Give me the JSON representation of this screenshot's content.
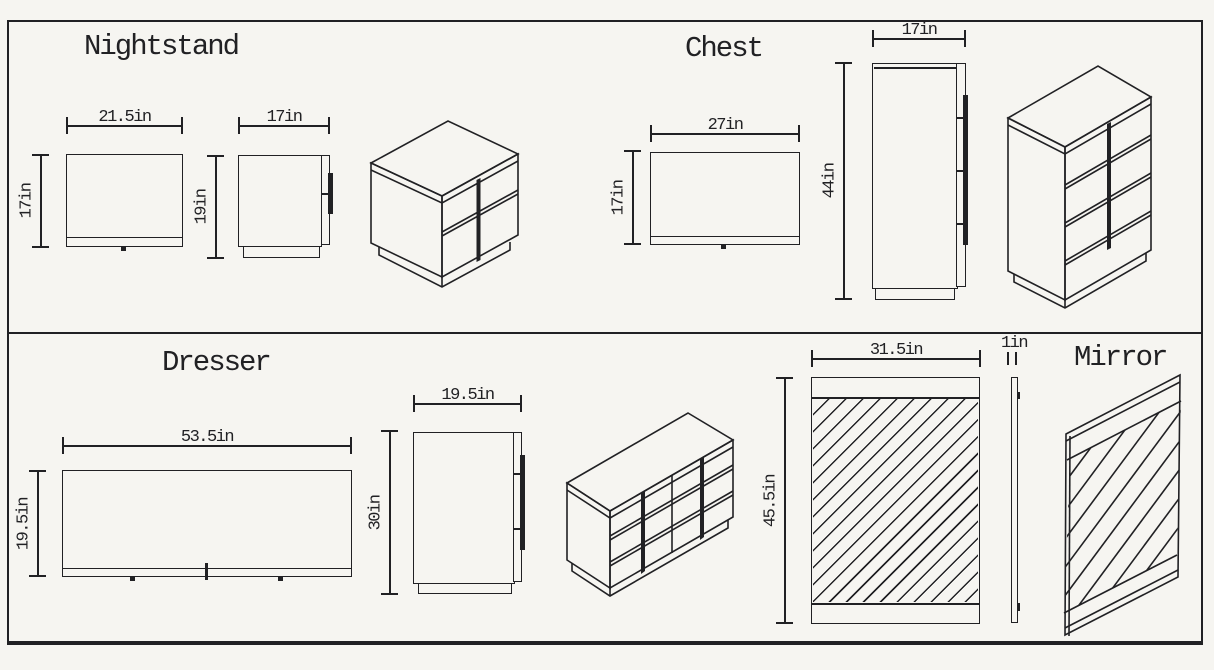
{
  "paper": {
    "background": "#f6f5f1",
    "ink": "#212124"
  },
  "nightstand": {
    "title": "Nightstand",
    "front_width": "21.5in",
    "front_height": "17in",
    "side_width": "17in",
    "side_height": "19in"
  },
  "chest": {
    "title": "Chest",
    "top_width": "27in",
    "top_height": "17in",
    "side_width": "17in",
    "side_height": "44in"
  },
  "dresser": {
    "title": "Dresser",
    "top_width": "53.5in",
    "top_height": "19.5in",
    "side_width": "19.5in",
    "side_height": "30in"
  },
  "mirror": {
    "title": "Mirror",
    "width": "31.5in",
    "height": "45.5in",
    "depth": "1in"
  }
}
